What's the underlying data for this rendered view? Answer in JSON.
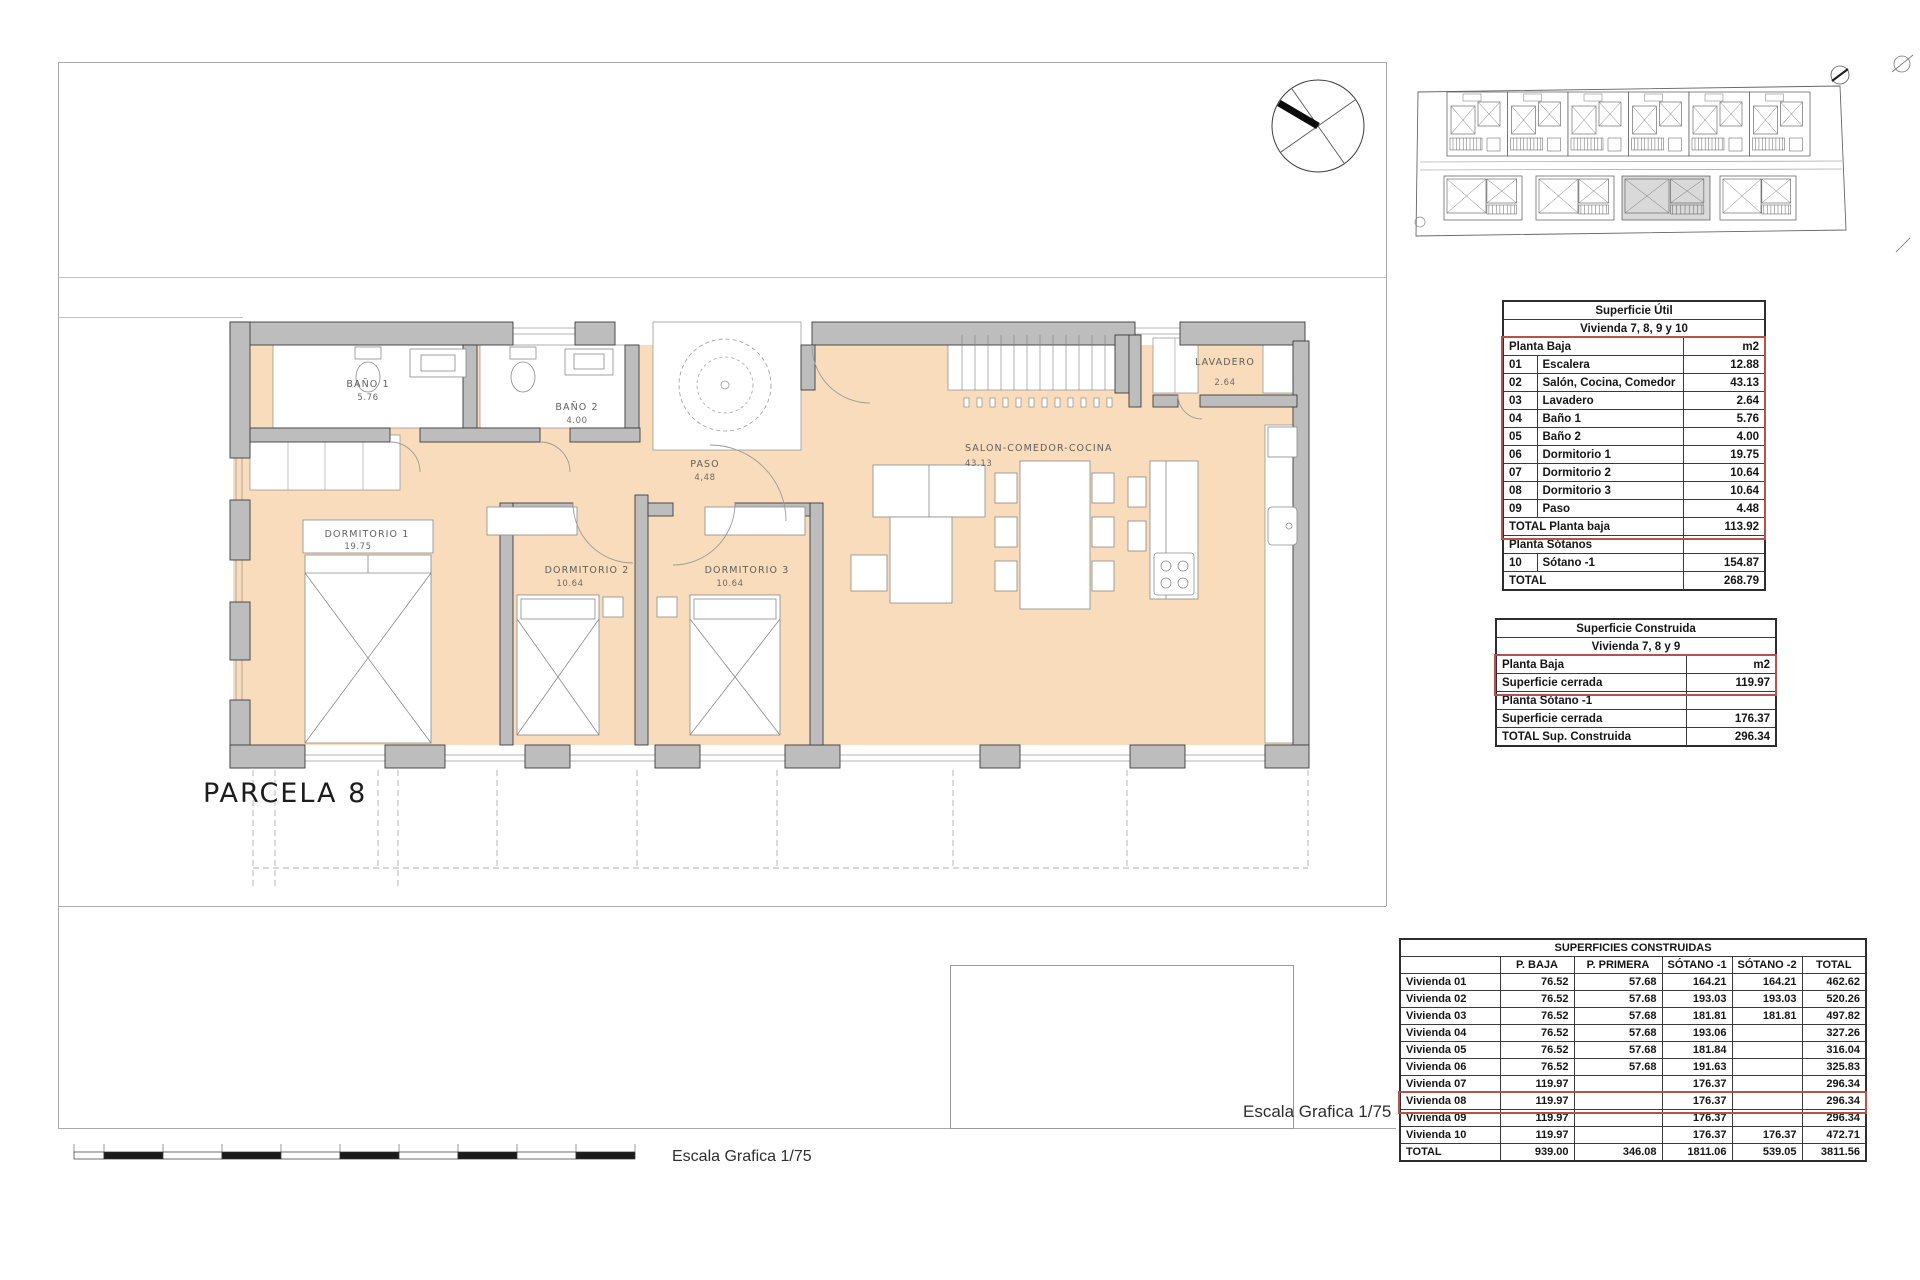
{
  "plan": {
    "parcela": "PARCELA 8",
    "scale_text_bottom": "Escala Grafica 1/75",
    "scale_text_right": "Escala Grafica 1/75",
    "rooms": {
      "bano1": {
        "name": "BAÑO 1",
        "area": "5.76"
      },
      "bano2": {
        "name": "BAÑO 2",
        "area": "4.00"
      },
      "paso": {
        "name": "PASO",
        "area": "4,48"
      },
      "dorm1": {
        "name": "DORMITORIO 1",
        "area": "19.75"
      },
      "dorm2": {
        "name": "DORMITORIO 2",
        "area": "10.64"
      },
      "dorm3": {
        "name": "DORMITORIO 3",
        "area": "10.64"
      },
      "salon": {
        "name": "SALON-COMEDOR-COCINA",
        "area": "43.13"
      },
      "lavadero": {
        "name": "LAVADERO",
        "area": "2.64"
      }
    }
  },
  "superficie_util": {
    "title": "Superficie Útil",
    "subtitle": "Vivienda 7, 8, 9 y 10",
    "header": {
      "label": "Planta Baja",
      "unit": "m2"
    },
    "rows": [
      {
        "num": "01",
        "name": "Escalera",
        "value": "12.88"
      },
      {
        "num": "02",
        "name": "Salón, Cocina, Comedor",
        "value": "43.13"
      },
      {
        "num": "03",
        "name": "Lavadero",
        "value": "2.64"
      },
      {
        "num": "04",
        "name": "Baño 1",
        "value": "5.76"
      },
      {
        "num": "05",
        "name": "Baño 2",
        "value": "4.00"
      },
      {
        "num": "06",
        "name": "Dormitorio 1",
        "value": "19.75"
      },
      {
        "num": "07",
        "name": "Dormitorio 2",
        "value": "10.64"
      },
      {
        "num": "08",
        "name": "Dormitorio 3",
        "value": "10.64"
      },
      {
        "num": "09",
        "name": "Paso",
        "value": "4.48"
      }
    ],
    "total_planta_baja": {
      "label": "TOTAL Planta baja",
      "value": "113.92"
    },
    "sotanos_header": "Planta Sótanos",
    "sotano_row": {
      "num": "10",
      "name": "Sótano -1",
      "value": "154.87"
    },
    "total": {
      "label": "TOTAL",
      "value": "268.79"
    }
  },
  "superficie_construida": {
    "title": "Superficie Construida",
    "subtitle": "Vivienda 7, 8 y 9",
    "rows": [
      {
        "label": "Planta Baja",
        "value": "m2"
      },
      {
        "label": "Superficie cerrada",
        "value": "119.97"
      },
      {
        "label": "Planta Sótano -1",
        "value": ""
      },
      {
        "label": "Superficie cerrada",
        "value": "176.37"
      },
      {
        "label": "TOTAL Sup. Construida",
        "value": "296.34"
      }
    ]
  },
  "superficies_construidas": {
    "title": "SUPERFICIES CONSTRUIDAS",
    "columns": [
      "",
      "P. BAJA",
      "P. PRIMERA",
      "SÓTANO -1",
      "SÓTANO -2",
      "TOTAL"
    ],
    "rows": [
      {
        "label": "Vivienda 01",
        "values": [
          "76.52",
          "57.68",
          "164.21",
          "164.21",
          "462.62"
        ],
        "highlight": false
      },
      {
        "label": "Vivienda 02",
        "values": [
          "76.52",
          "57.68",
          "193.03",
          "193.03",
          "520.26"
        ],
        "highlight": false
      },
      {
        "label": "Vivienda 03",
        "values": [
          "76.52",
          "57.68",
          "181.81",
          "181.81",
          "497.82"
        ],
        "highlight": false
      },
      {
        "label": "Vivienda 04",
        "values": [
          "76.52",
          "57.68",
          "193.06",
          "",
          "327.26"
        ],
        "highlight": false
      },
      {
        "label": "Vivienda 05",
        "values": [
          "76.52",
          "57.68",
          "181.84",
          "",
          "316.04"
        ],
        "highlight": false
      },
      {
        "label": "Vivienda 06",
        "values": [
          "76.52",
          "57.68",
          "191.63",
          "",
          "325.83"
        ],
        "highlight": false
      },
      {
        "label": "Vivienda 07",
        "values": [
          "119.97",
          "",
          "176.37",
          "",
          "296.34"
        ],
        "highlight": false
      },
      {
        "label": "Vivienda 08",
        "values": [
          "119.97",
          "",
          "176.37",
          "",
          "296.34"
        ],
        "highlight": true
      },
      {
        "label": "Vivienda 09",
        "values": [
          "119.97",
          "",
          "176.37",
          "",
          "296.34"
        ],
        "highlight": false
      },
      {
        "label": "Vivienda 10",
        "values": [
          "119.97",
          "",
          "176.37",
          "176.37",
          "472.71"
        ],
        "highlight": false
      },
      {
        "label": "TOTAL",
        "values": [
          "939.00",
          "346.08",
          "1811.06",
          "539.05",
          "3811.56"
        ],
        "highlight": false
      }
    ]
  }
}
